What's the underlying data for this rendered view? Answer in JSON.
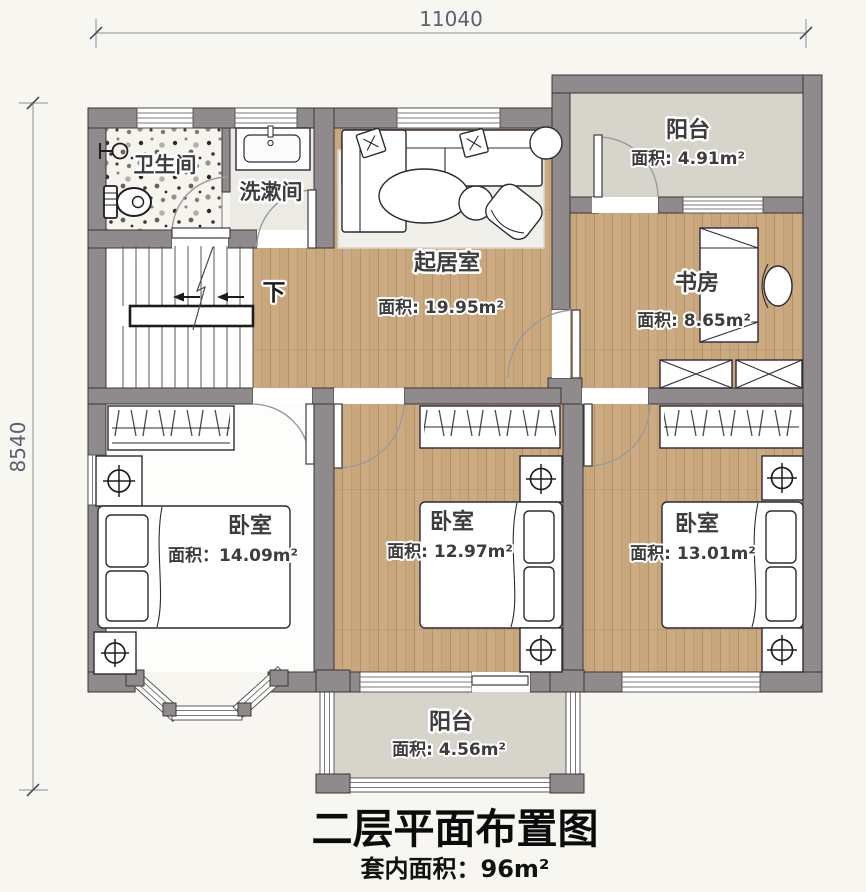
{
  "title": {
    "main": "二层平面布置图",
    "sub": "套内面积：96m²"
  },
  "dimensions": {
    "top": "11040",
    "left": "8540"
  },
  "rooms": {
    "bathroom": {
      "name": "卫生间"
    },
    "washroom": {
      "name": "洗漱间"
    },
    "living": {
      "name": "起居室",
      "area": "面积: 19.95m²"
    },
    "balcony_top": {
      "name": "阳台",
      "area": "面积: 4.91m²"
    },
    "study": {
      "name": "书房",
      "area": "面积: 8.65m²"
    },
    "bedroom_left": {
      "name": "卧室",
      "area": "面积：14.09m²"
    },
    "bedroom_middle": {
      "name": "卧室",
      "area": "面积: 12.97m²"
    },
    "bedroom_right": {
      "name": "卧室",
      "area": "面积: 13.01m²"
    },
    "balcony_bottom": {
      "name": "阳台",
      "area": "面积: 4.56m²"
    }
  },
  "stairs": {
    "down_label": "下"
  },
  "colors": {
    "wall": "#8f8b8c",
    "wood_floor": "#c9a77d",
    "balcony_floor": "#d7d4cb",
    "terrazzo_base": "#f6f4ee",
    "background": "#f8f6f1",
    "label_text": "#3d3d3d",
    "dimension_text": "#5b6070"
  }
}
